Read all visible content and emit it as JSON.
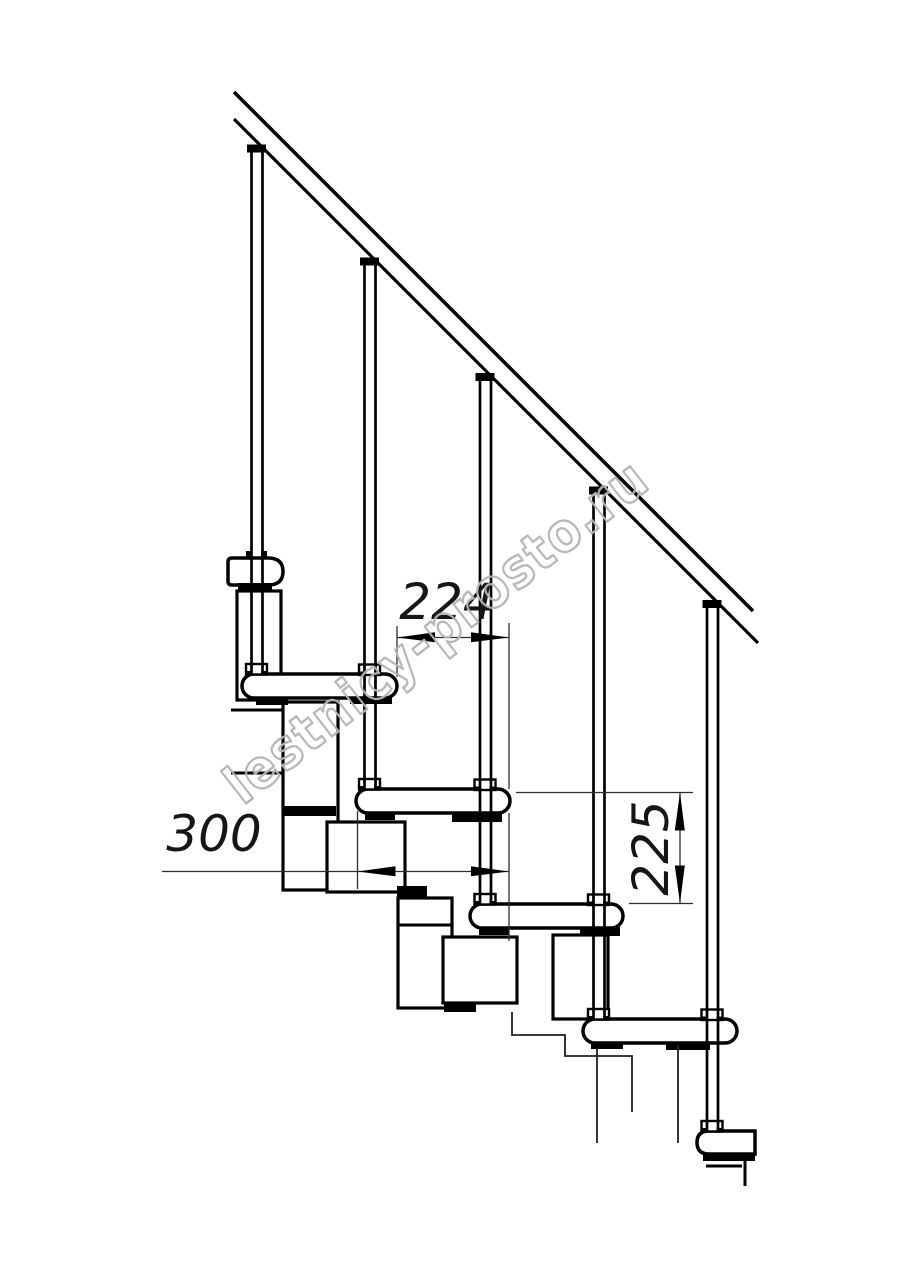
{
  "drawing": {
    "type": "technical-line-drawing",
    "subject": "modular staircase side elevation",
    "watermark": "lestnicy-prosto.ru",
    "background": "#ffffff",
    "line_color": "#000000",
    "dimension_line_color": "#2e2e2e",
    "watermark_color": "#b5b5b5",
    "balusters_count": 5,
    "treads_count": 5,
    "dimensions": {
      "going": {
        "value": "224",
        "orientation": "horizontal"
      },
      "depth": {
        "value": "300",
        "orientation": "horizontal"
      },
      "rise": {
        "value": "225",
        "orientation": "vertical"
      }
    }
  }
}
